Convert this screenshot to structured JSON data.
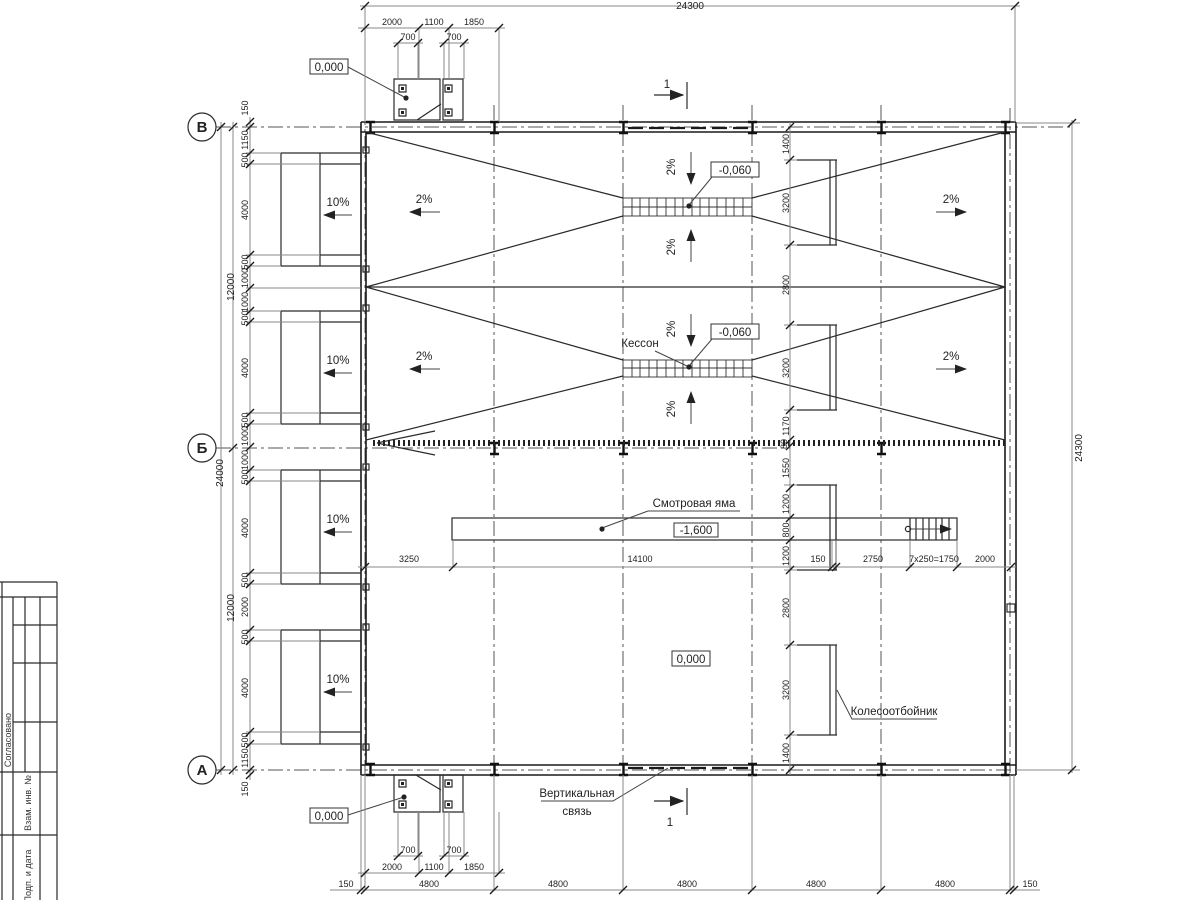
{
  "axes": {
    "v": "В",
    "b": "Б",
    "a": "А"
  },
  "section": {
    "label": "1"
  },
  "titleblock": {
    "agreed": "Согласовано",
    "vzam": "Взам. инв. №",
    "podp": "Подп. и дата"
  },
  "marks": {
    "zero": "0,000",
    "minus060": "-0,060",
    "minus1600": "-1,600"
  },
  "notes": {
    "kesson": "Кессон",
    "pit": "Смотровая яма",
    "wheel": "Колесоотбойник",
    "brace1": "Вертикальная",
    "brace2": "связь"
  },
  "slopes": {
    "ramp": "10%",
    "floor": "2%"
  },
  "dims": {
    "top_overall": "24300",
    "right_overall": "24300",
    "left_overall": "24000",
    "left_half": "12000",
    "plate": "700",
    "gate_chain": [
      "2000",
      "1100",
      "1850"
    ],
    "bay": "4800",
    "edge": "150",
    "left_chain": [
      "1150",
      "500",
      "4000",
      "500",
      "1000",
      "1000",
      "500",
      "4000",
      "500",
      "1000",
      "1000",
      "500",
      "4000",
      "500",
      "2000",
      "500",
      "4000",
      "500",
      "1150"
    ],
    "right_chain": [
      "1400",
      "3200",
      "2800",
      "3200",
      "1170",
      "80",
      "1550",
      "1200",
      "800",
      "1200",
      "2800",
      "3200",
      "1400"
    ],
    "pit_chain": [
      "3250",
      "14100",
      "150",
      "2750",
      "7x250=1750",
      "2000"
    ]
  }
}
